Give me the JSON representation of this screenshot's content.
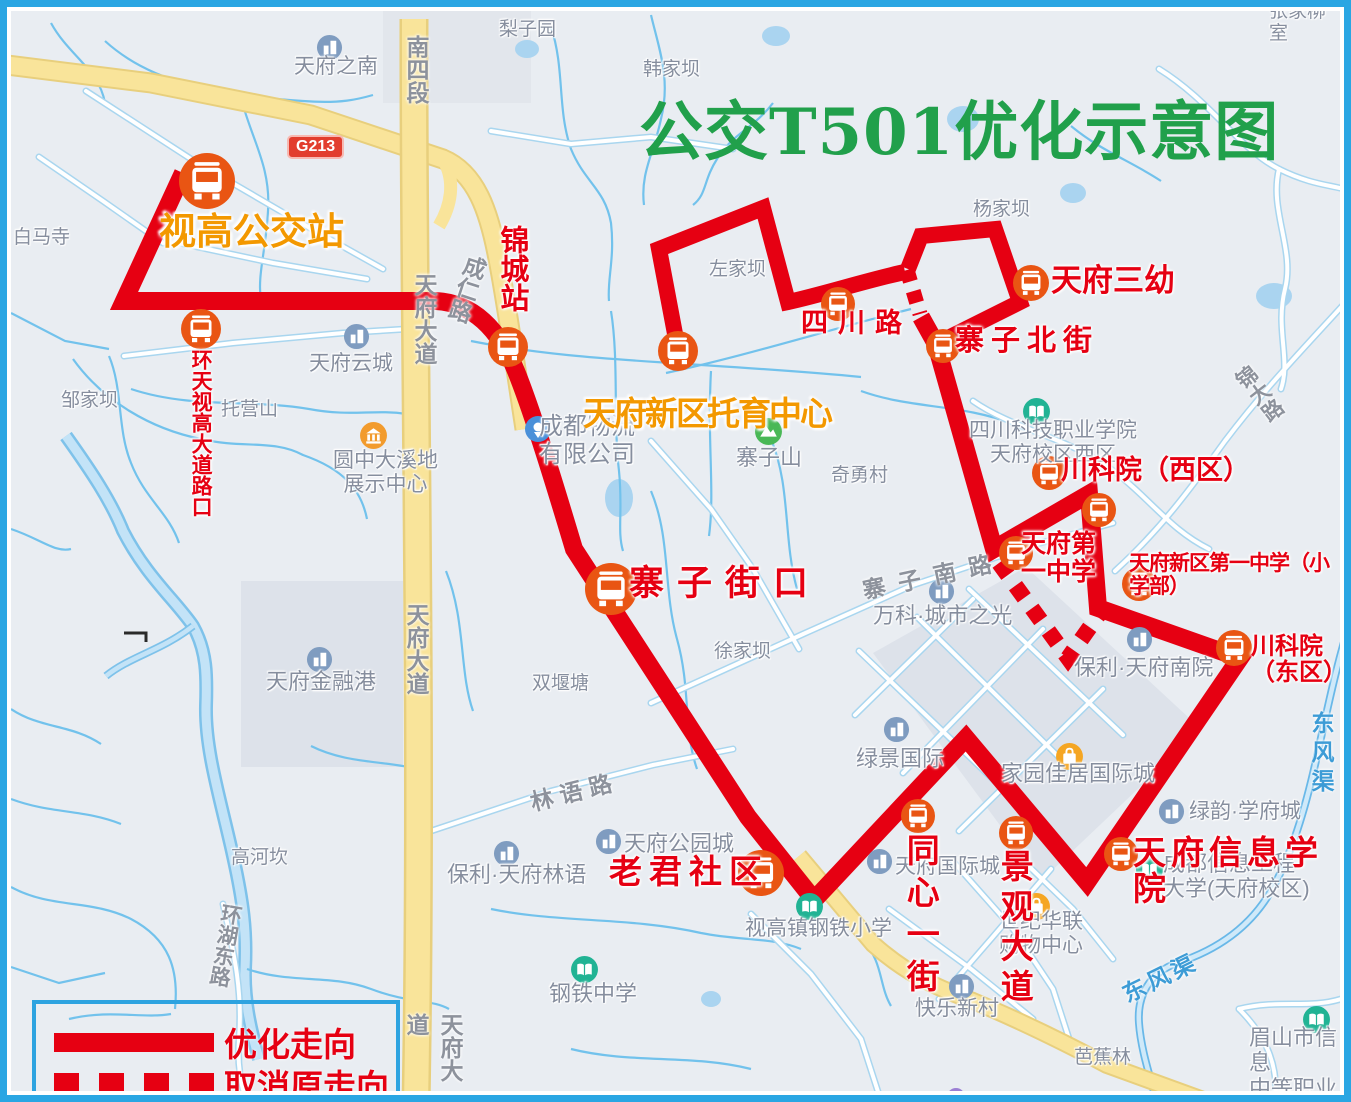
{
  "title": "公交T501优化示意图",
  "legend": {
    "optimized": "优化走向",
    "cancelled": "取消原走向"
  },
  "colors": {
    "route_red": "#e60012",
    "station_orange": "#e95513",
    "label_orange": "#f39800",
    "title_green": "#21a04b",
    "road_yellow": "#f9e49a",
    "water_blue": "#aad4f0",
    "frame_blue": "#2aa6e3"
  },
  "stations": {
    "shigao_bus_station": "视高公交站",
    "huantian_shigao_intersection": "环天视高大道路口",
    "jincheng": "锦城站",
    "tuoyu_center": "天府新区托育中心",
    "sichuan_road": "四川路",
    "tianfu_no3_kindergarten": "天府三幼",
    "zhaizi_north_street": "寨子北街",
    "ckxy_west": "川科院（西区）",
    "tianfu_no1_middle": "天府第\n一中学",
    "tfxq_no1_primary": "天府新区第一中学（小学部）",
    "ckxy_east": "川科院（东区）",
    "zhaizi_jiekou": "寨子街口",
    "laojun_community": "老君社区",
    "tongxin_street": "同心一街",
    "jingguan_avenue": "景观大道",
    "tianfu_info_college": "天府信息学院"
  },
  "roads": {
    "nansiduan": "南四段",
    "tianfu_avenue": "天府大道",
    "g213": "G213",
    "chengren_road": "成仁路",
    "jinda_road": "锦大路",
    "zhaizi_south_road": "寨子南路",
    "linyu_road": "林语路",
    "huanhu_east_road": "环湖东路",
    "dongfengqu": "东风渠"
  },
  "places": {
    "tianfu_zhinan": "天府之南",
    "lizi_yuan": "梨子园",
    "hanjiaba": "韩家坝",
    "zhangjia": "张家柳室",
    "zuojiaba": "左家坝",
    "yangjiaba": "杨家坝",
    "baimasi": "白马寺",
    "zoujiaba": "邹家坝",
    "tuoyingshan": "托营山",
    "tianfu_yuncheng": "天府云城",
    "yuanzhong_daxidi": "圆中大溪地\n展示中心",
    "chengdu_logistics": "成都物流\n有限公司",
    "zhaizishan": "寨子山",
    "qiyongcun": "奇勇村",
    "sckj_college": "四川科技职业学院\n天府校区西区",
    "xujiaba": "徐家坝",
    "shuangyantang": "双堰塘",
    "wanke": "万科·城市之光",
    "tianfu_financial_port": "天府金融港",
    "gaohekan": "高河坎",
    "lvjing_intl": "绿景国际",
    "baoli_nanyuan": "保利·天府南院",
    "jiayuan_intl": "家园佳居国际城",
    "lvyun_xuefucheng": "绿韵·学府城",
    "baoli_linyu": "保利·天府林语",
    "tianfu_parkcity": "天府公园城",
    "tianfu_intl_city": "天府国际城",
    "shiji_hualian": "世纪华联\n购物中心",
    "shigao_steel_primary": "视高镇钢铁小学",
    "steel_middle": "钢铁中学",
    "kuaile_xincun": "快乐新村",
    "cduit": "成都信息工程\n大学(天府校区)",
    "bajiaolin": "芭蕉林",
    "meishan_vocational": "眉山市信息\n中等职业技术学校"
  }
}
